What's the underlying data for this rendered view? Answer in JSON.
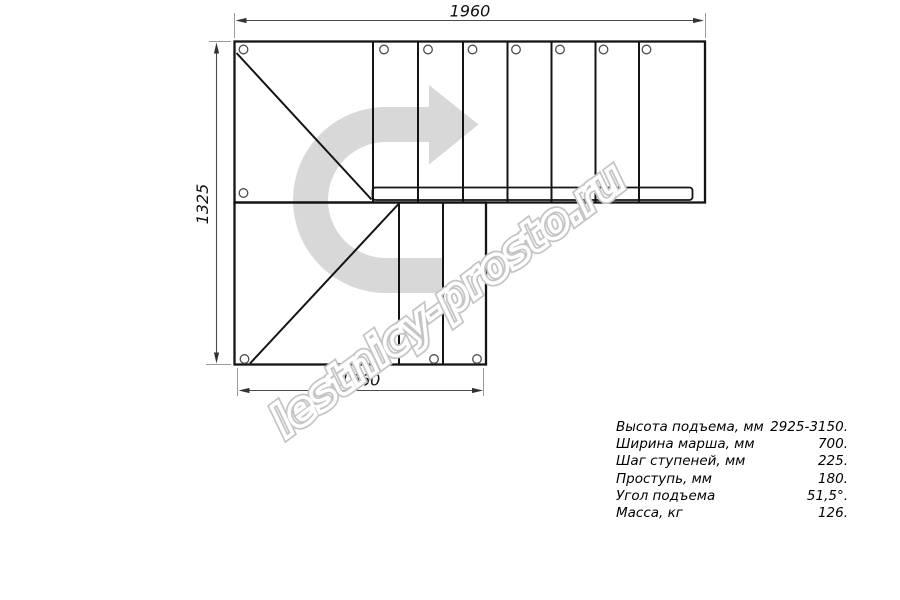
{
  "dimensions": {
    "top_width_mm": "1960",
    "left_height_mm": "1325",
    "bottom_width_mm": "1060"
  },
  "specs": {
    "rows": [
      {
        "label": "Высота подъема, мм",
        "value": "2925-3150."
      },
      {
        "label": "Ширина марша, мм",
        "value": "700."
      },
      {
        "label": "Шаг ступеней, мм",
        "value": "225."
      },
      {
        "label": "Проступь, мм",
        "value": "180."
      },
      {
        "label": "Угол подъема",
        "value": "51,5°."
      },
      {
        "label": "Масса, кг",
        "value": "126."
      }
    ]
  },
  "watermark": {
    "text": "lestnicy-prosto.ru"
  },
  "figure": {
    "type": "staircase-plan-top-view",
    "upper_flight_treads": 7,
    "lower_flight_treads": 2,
    "landing_panels": 2,
    "mounting_hole_count": 12,
    "turn_direction": "right"
  },
  "colors": {
    "background": "#ffffff",
    "line": "#141414",
    "dimension": "#4a4a4a",
    "extension": "#9a9a9a",
    "watermark_arrow": "#d8d8d8",
    "watermark_text_outline": "#c5c5c5"
  }
}
